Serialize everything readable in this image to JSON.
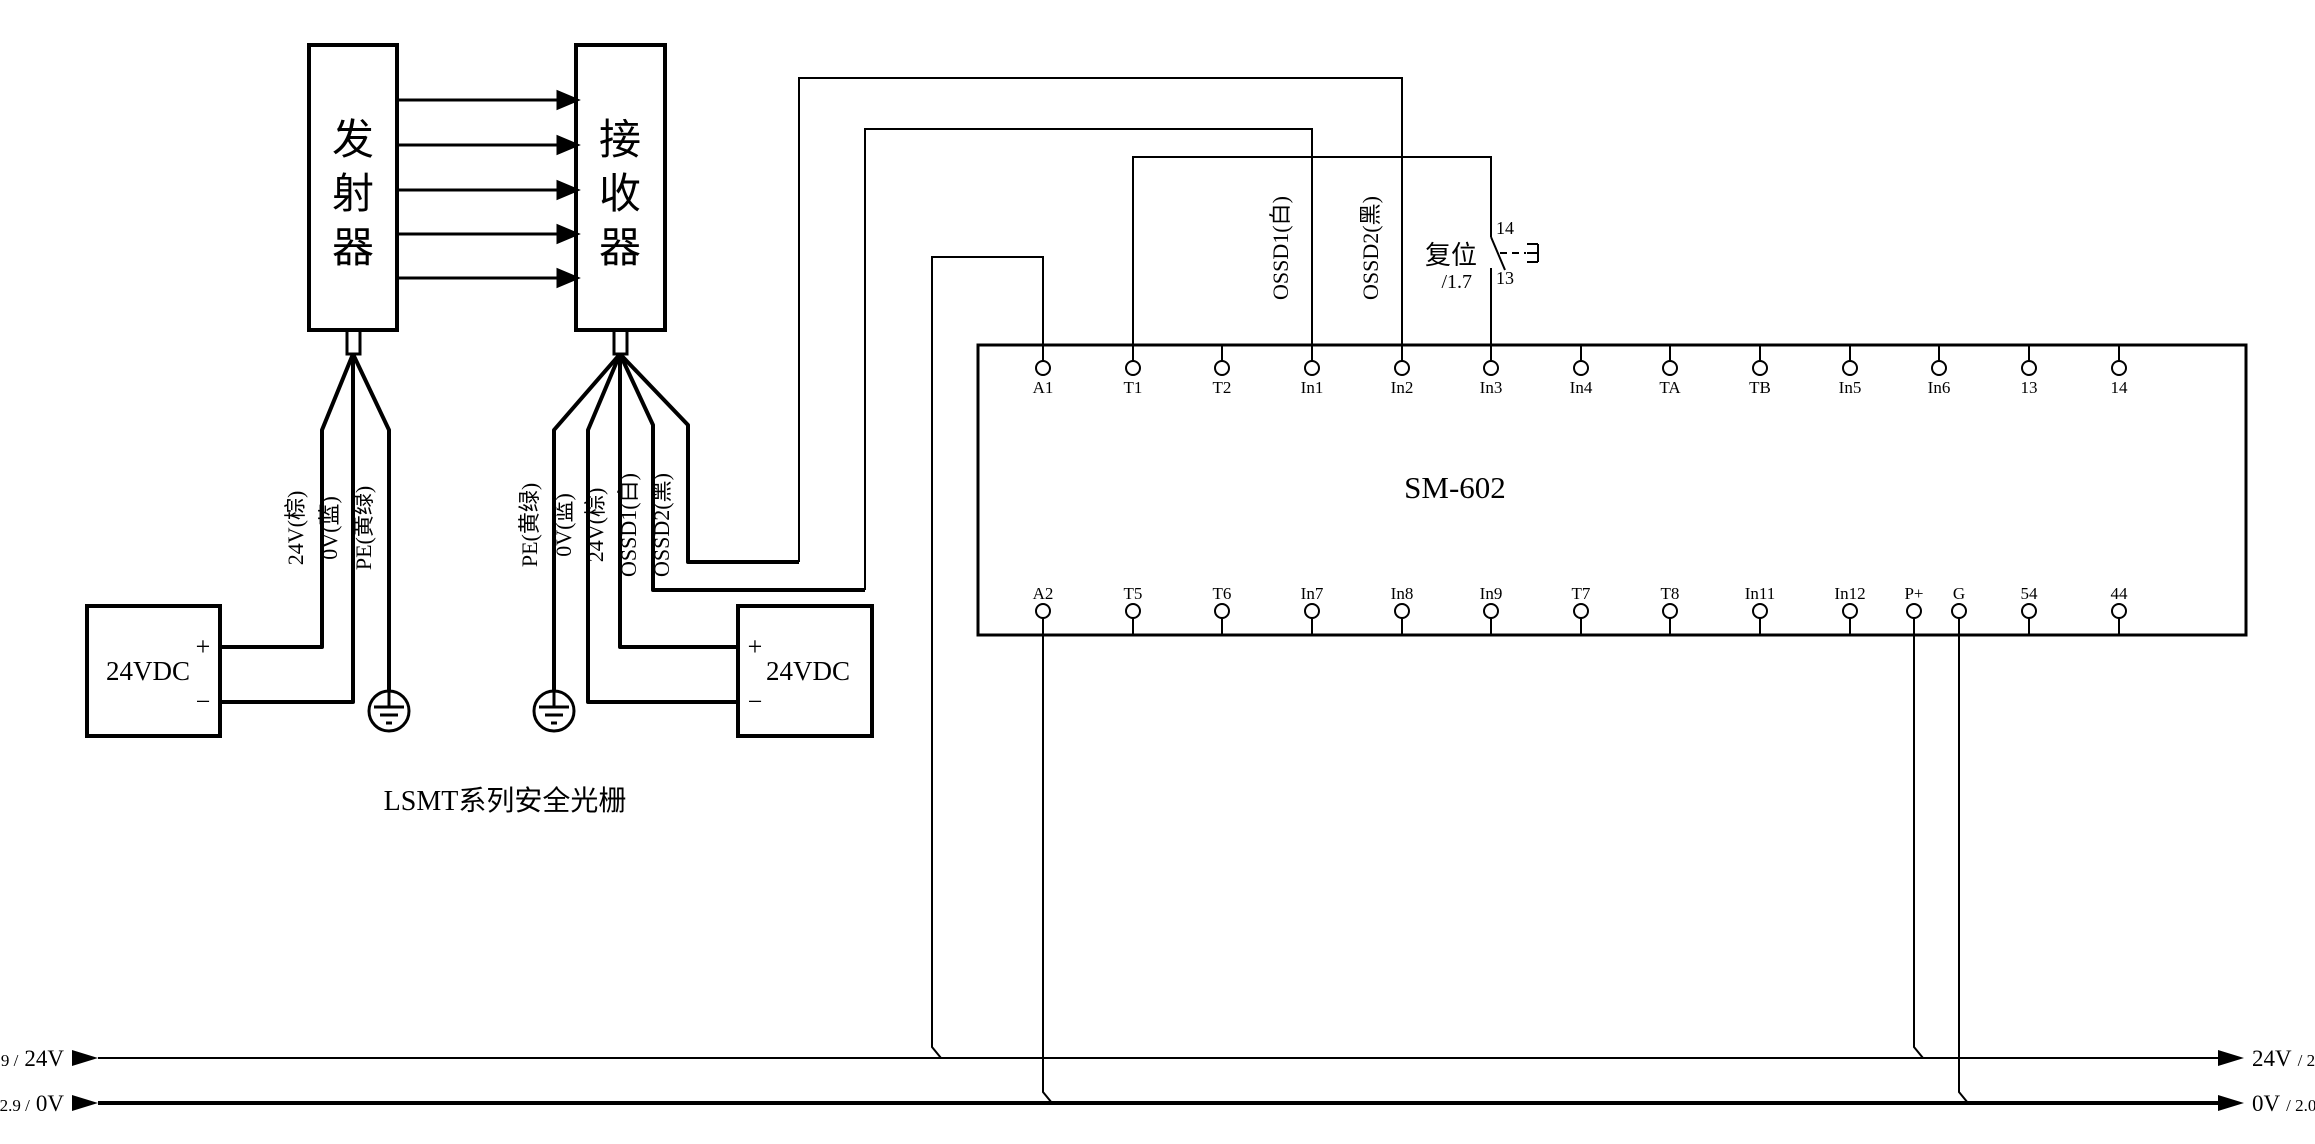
{
  "colors": {
    "line": "#000000",
    "background": "#ffffff"
  },
  "light_curtain": {
    "transmitter_chars": [
      "发",
      "射",
      "器"
    ],
    "receiver_chars": [
      "接",
      "收",
      "器"
    ],
    "caption": "LSMT系列安全光栅",
    "tx_wire_labels": [
      "24V(棕)",
      "0V(蓝)",
      "PE(黄绿)"
    ],
    "rx_wire_labels": [
      "PE(黄绿)",
      "0V(蓝)",
      "24V(棕)",
      "OSSD1(白)",
      "OSSD2(黑)"
    ]
  },
  "supplies": {
    "left": {
      "label": "24VDC",
      "plus": "+",
      "minus": "−"
    },
    "right": {
      "label": "24VDC",
      "plus": "+",
      "minus": "−"
    }
  },
  "module": {
    "name": "SM-602",
    "top_terminals": [
      "A1",
      "T1",
      "T2",
      "In1",
      "In2",
      "In3",
      "In4",
      "TA",
      "TB",
      "In5",
      "In6",
      "13",
      "14"
    ],
    "bottom_terminals": [
      "A2",
      "T5",
      "T6",
      "In7",
      "In8",
      "In9",
      "T7",
      "T8",
      "In11",
      "In12",
      "P+",
      "G",
      "54",
      "44"
    ]
  },
  "ossd_labels": {
    "ossd1": "OSSD1(白)",
    "ossd2": "OSSD2(黑)"
  },
  "reset_switch": {
    "label": "复位",
    "ref": "/1.7",
    "contact_top": "14",
    "contact_bottom": "13"
  },
  "rails": {
    "left_24v": {
      "ref": "2.9 /",
      "name": "24V"
    },
    "left_0v": {
      "ref": "2.9 /",
      "name": "0V"
    },
    "right_24v": {
      "name": "24V",
      "ref": "/ 2.0"
    },
    "right_0v": {
      "name": "0V",
      "ref": "/ 2.0"
    }
  }
}
